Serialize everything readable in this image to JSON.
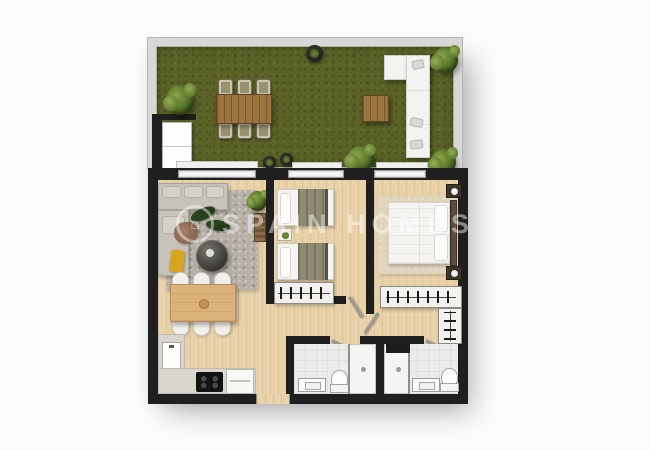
{
  "watermark": {
    "text": "SPAIN HOMES",
    "logo_icon": "house-circle-logo",
    "logo_glyph": "⌂"
  },
  "colors": {
    "canvas_bg": "#fbfbfb",
    "wall": "#1f1f1f",
    "parapet": "#d7d7d7",
    "grass": "#5a6226",
    "wood_floor": "#e9d2a9",
    "terrace_wood": "#9c7440",
    "indoor_table_wood": "#dcb27c",
    "rug_gray": "#b5afa6",
    "sofa_gray": "#c7c3ba",
    "bed_white": "#f4f3f0",
    "blanket_olive": "#8f8b72",
    "bath_floor": "#ebebe9",
    "accent_throw": "#d9a520",
    "plant_green": "#5d7a2c"
  },
  "plan": {
    "type": "apartment-floor-plan-top-view",
    "areas": [
      {
        "name": "terrace",
        "surface": "grass",
        "furniture": [
          "outdoor-dining-table",
          "outdoor-chairs-x6",
          "outdoor-corner-sofa",
          "outdoor-coffee-table",
          "storage-closet",
          "round-planter",
          "bushes-x4",
          "potted-plants-x2"
        ]
      },
      {
        "name": "living-room-with-open-kitchen",
        "surface": "wood",
        "furniture": [
          "corner-sofa",
          "area-rug",
          "round-coffee-table",
          "yellow-throw",
          "plant-decor",
          "wall-shelf",
          "dining-table",
          "dining-chairs-x6",
          "kitchen-counter-l-shape",
          "sink",
          "cooktop",
          "appliance"
        ]
      },
      {
        "name": "bedroom-middle",
        "surface": "wood",
        "furniture": [
          "single-bed",
          "single-bed",
          "nightstand",
          "wardrobe-with-hangers"
        ]
      },
      {
        "name": "bedroom-right",
        "surface": "wood",
        "furniture": [
          "double-bed",
          "rug",
          "headboard",
          "nightstand-with-lamp",
          "nightstand-with-lamp",
          "l-shaped-wardrobe"
        ]
      },
      {
        "name": "bathroom-left",
        "surface": "tile",
        "furniture": [
          "vanity-sink",
          "toilet",
          "shower"
        ]
      },
      {
        "name": "bathroom-right",
        "surface": "tile",
        "furniture": [
          "shower",
          "dark-niche",
          "vanity-sink",
          "toilet"
        ]
      }
    ],
    "openings": [
      "entrance-door-bottom",
      "bedroom-doors-x2",
      "bathroom-doors-x2",
      "terrace-windows-x3"
    ]
  }
}
